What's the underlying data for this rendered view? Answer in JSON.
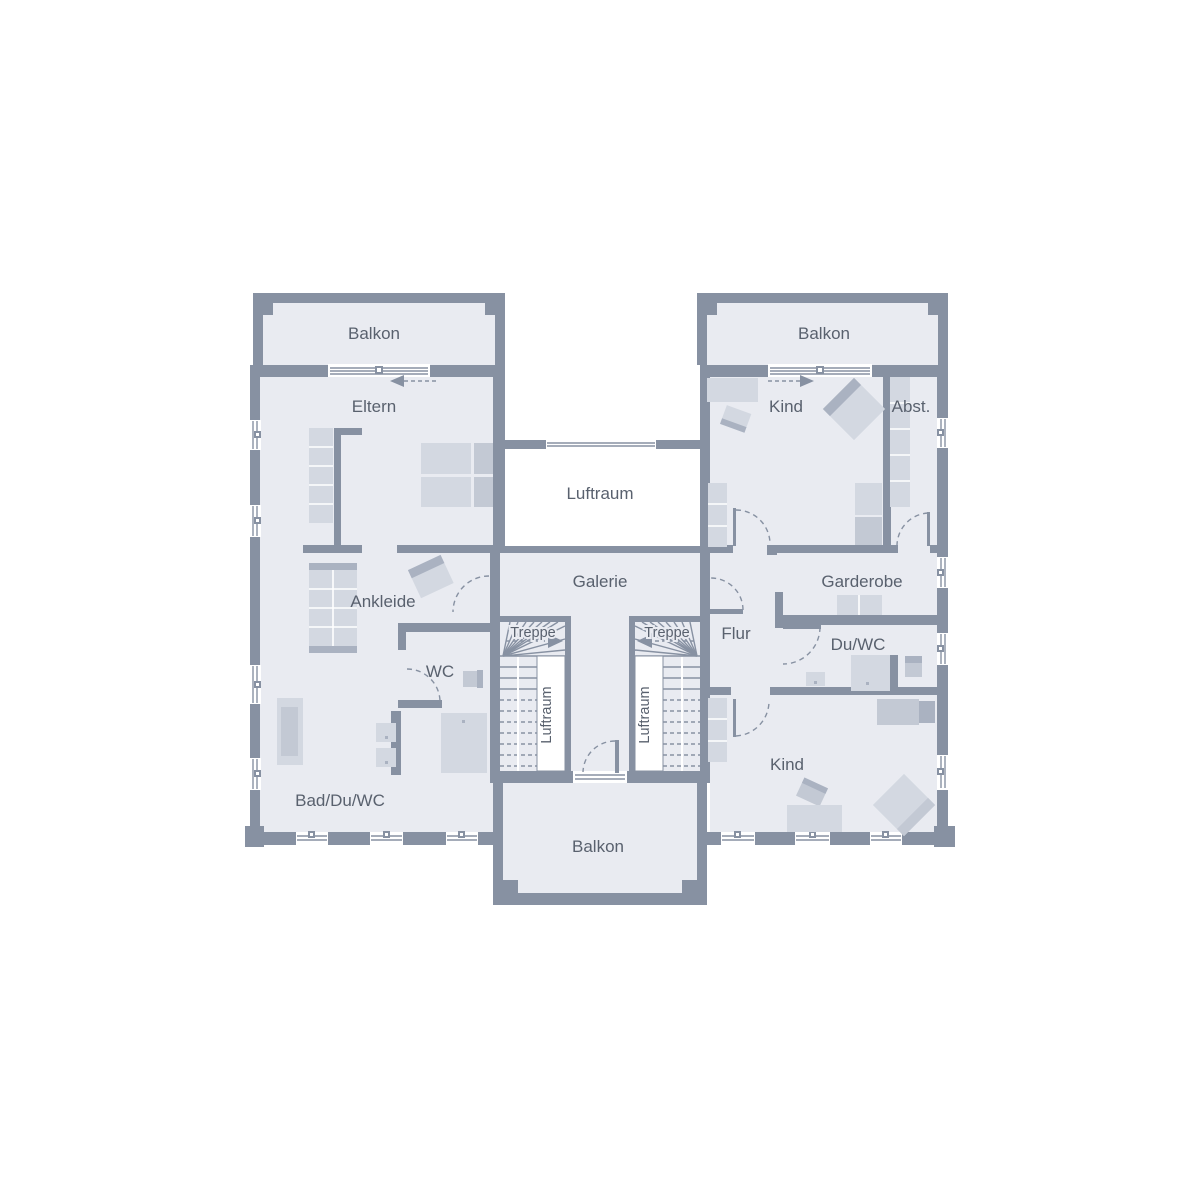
{
  "colors": {
    "wall": "#8791a2",
    "floor": "#e9ebf1",
    "void": "#ffffff",
    "furn": "#d3d8e1",
    "furn2": "#c3c9d4",
    "furn3": "#aab2c1",
    "line": "#8791a2",
    "text": "#59616e"
  },
  "labels": {
    "balkon_top_left": "Balkon",
    "balkon_top_right": "Balkon",
    "balkon_bottom": "Balkon",
    "eltern": "Eltern",
    "kind_top": "Kind",
    "kind_bottom": "Kind",
    "abstellraum": "Abst.",
    "luftraum_center": "Luftraum",
    "luftraum_stair_left": "Luftraum",
    "luftraum_stair_right": "Luftraum",
    "galerie": "Galerie",
    "ankleide": "Ankleide",
    "garderobe": "Garderobe",
    "flur": "Flur",
    "treppe_left": "Treppe",
    "treppe_right": "Treppe",
    "wc": "WC",
    "du_wc": "Du/WC",
    "bad_du_wc": "Bad/Du/WC"
  }
}
